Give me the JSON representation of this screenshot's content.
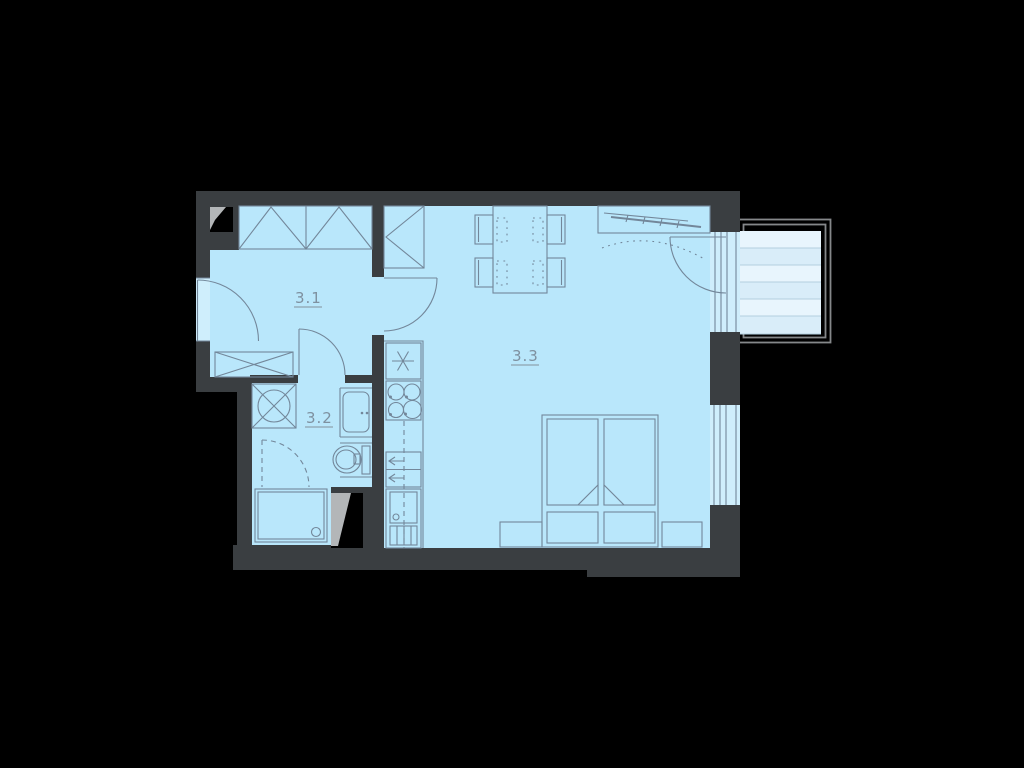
{
  "canvas": {
    "width": 1024,
    "height": 768,
    "background": "#000000"
  },
  "floor_plan": {
    "rooms": [
      {
        "label": "3.1"
      },
      {
        "label": "3.2"
      },
      {
        "label": "3.3"
      }
    ],
    "colors": {
      "wall": "#3a3e41",
      "floor": "#b9e7fb",
      "opening": "#cfeefc",
      "balcony_deck": "#d9edf9",
      "furniture_line": "#73879a",
      "label_text": "#7e91a0",
      "shaft_black": "#000000",
      "shaft_gray": "#b3b6b8",
      "balcony_frame": "#85888a"
    },
    "balcony": {
      "stripe_rows": 6
    },
    "furniture_icons": [
      "wardrobe-icon",
      "entrance-door-icon",
      "interior-door-icon",
      "washing-machine-icon",
      "bathroom-sink-icon",
      "toilet-icon",
      "shower-icon",
      "kitchen-sink-icon",
      "cooktop-icon",
      "dishwasher-icon",
      "fridge-icon",
      "dining-table-icon",
      "chair-icon",
      "double-bed-icon",
      "nightstand-icon",
      "wardrobe-rail-icon",
      "window-icon",
      "balcony-icon",
      "duct-shaft-icon"
    ]
  }
}
